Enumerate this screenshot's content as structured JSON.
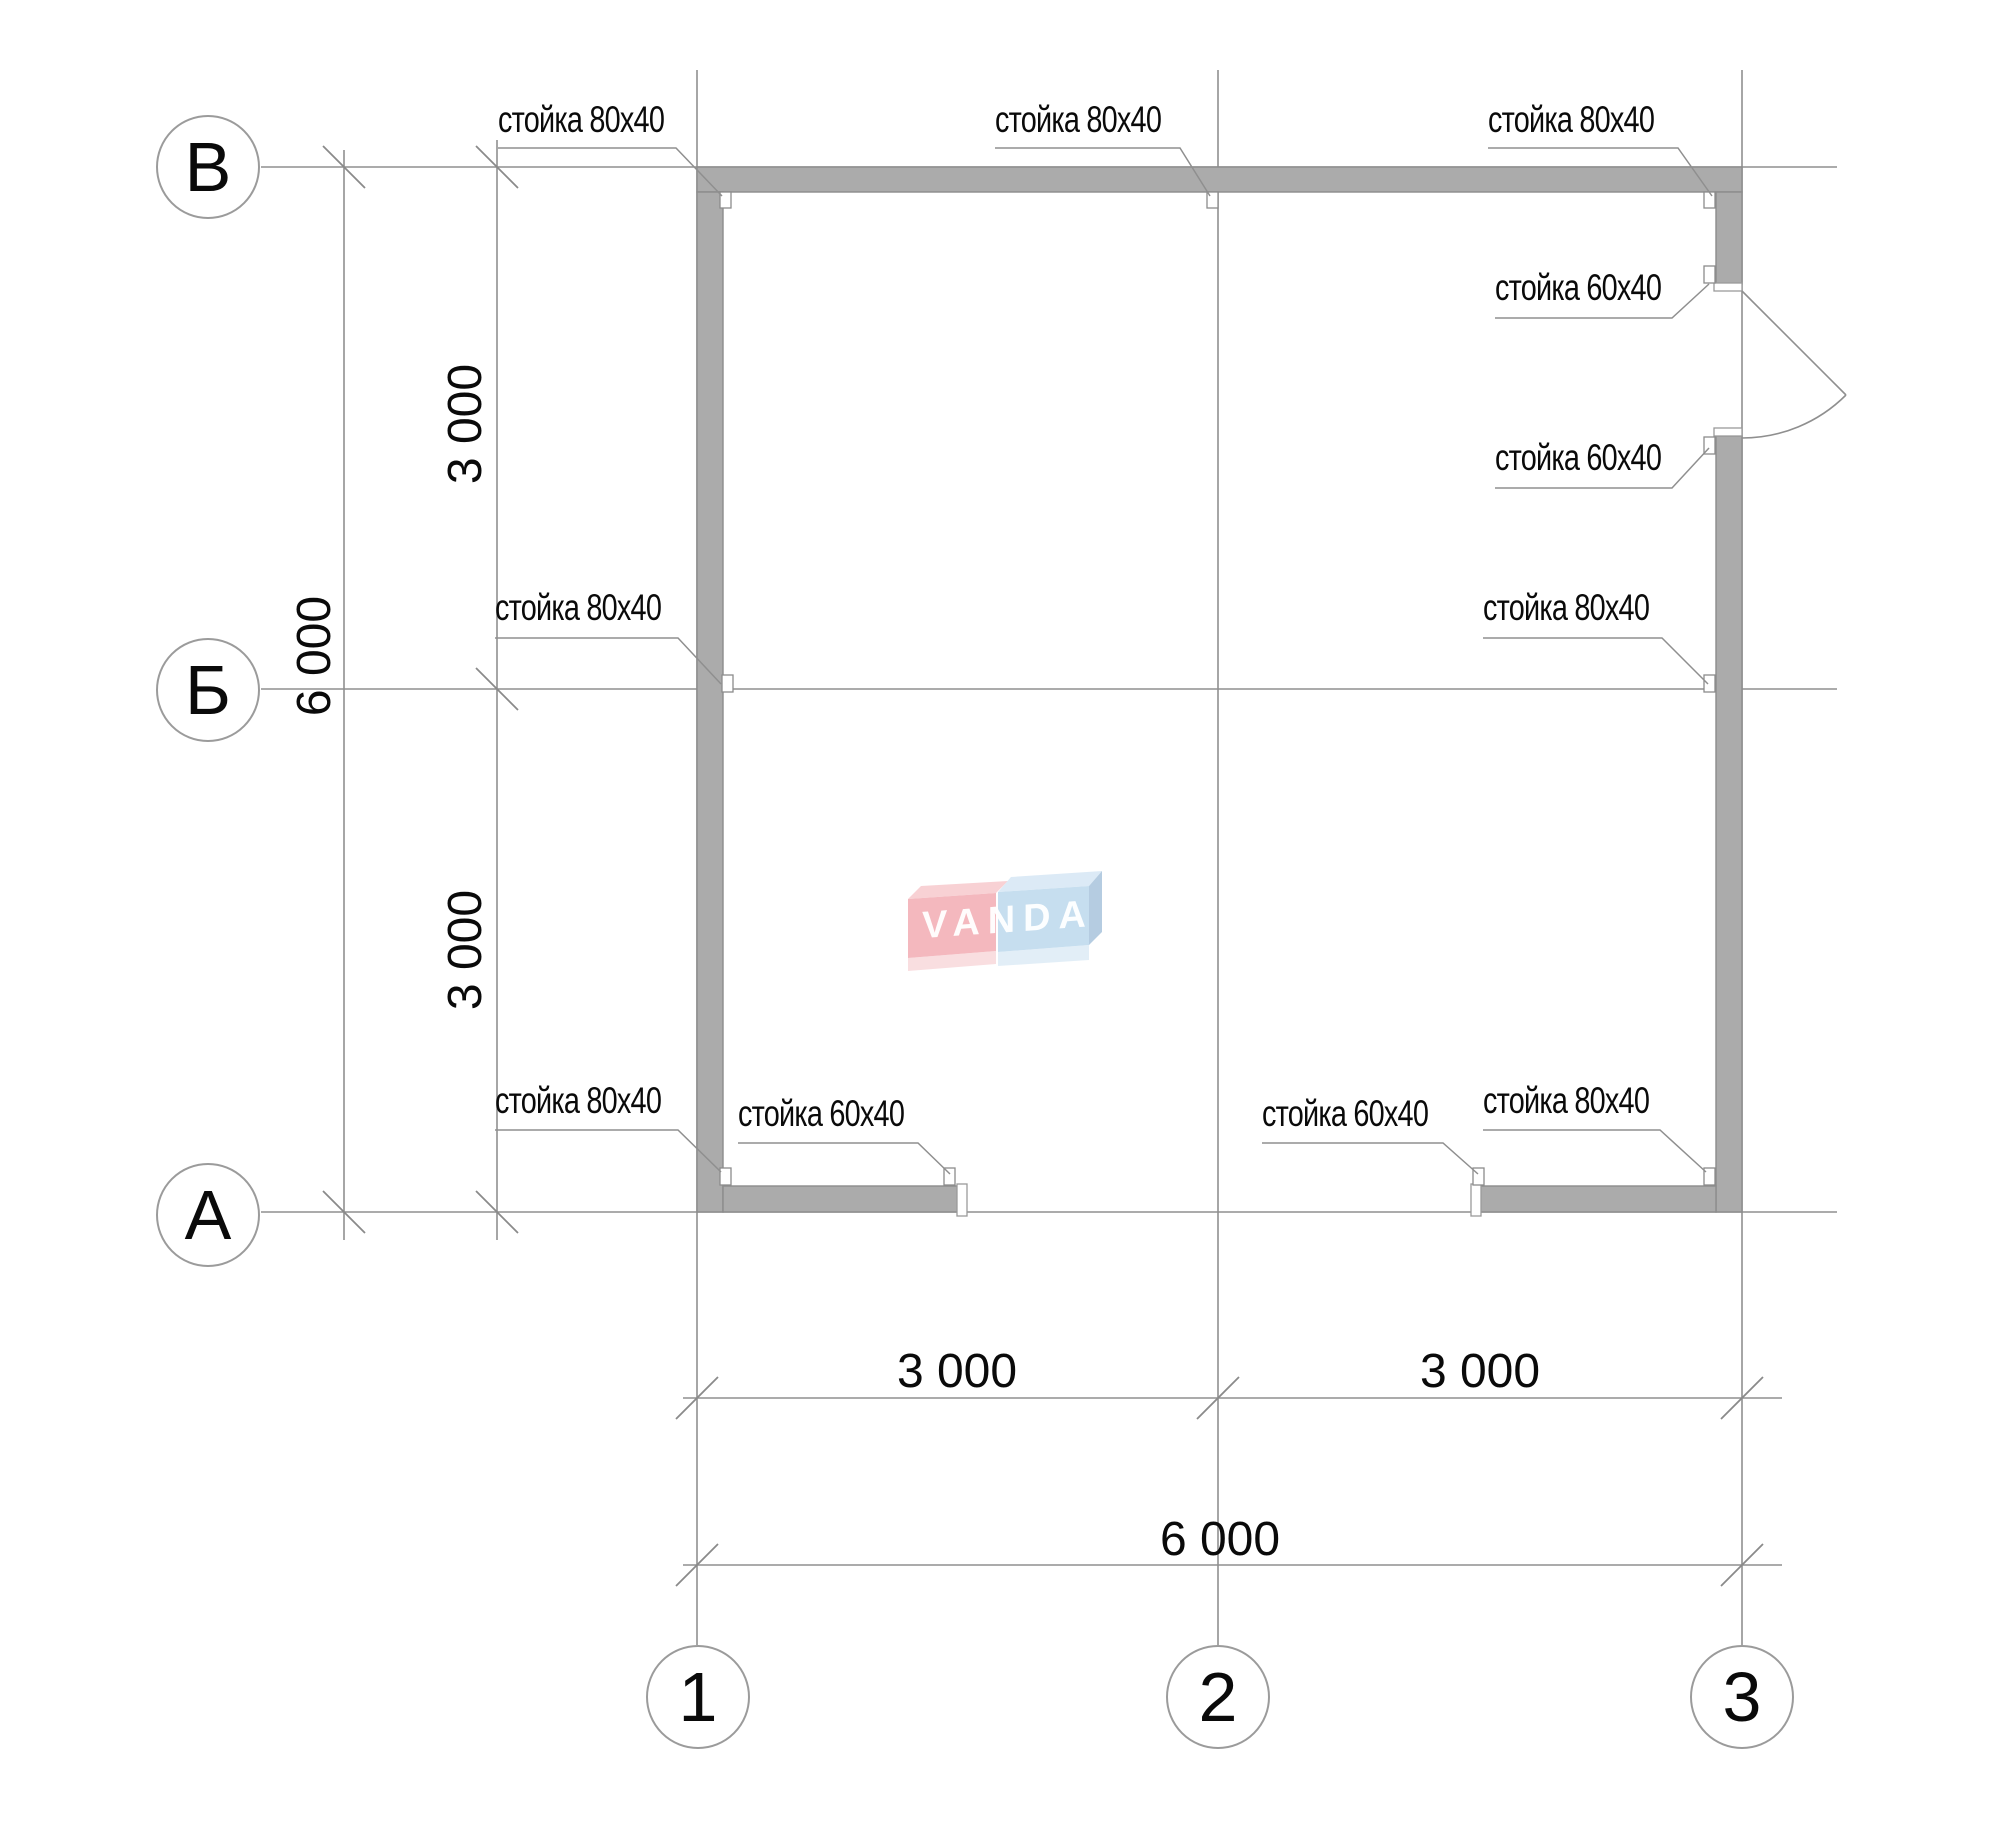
{
  "title": "frame-plan",
  "axes": {
    "rows": [
      {
        "label": "В"
      },
      {
        "label": "Б"
      },
      {
        "label": "А"
      }
    ],
    "cols": [
      {
        "label": "1"
      },
      {
        "label": "2"
      },
      {
        "label": "3"
      }
    ]
  },
  "dimensions": {
    "left_upper": "3 000",
    "left_lower": "3 000",
    "left_total": "6 000",
    "bottom_left": "3 000",
    "bottom_right": "3 000",
    "bottom_total": "6 000"
  },
  "callouts": [
    {
      "id": "top-left",
      "text": "стойка 80x40"
    },
    {
      "id": "top-middle",
      "text": "стойка 80x40"
    },
    {
      "id": "top-right",
      "text": "стойка 80x40"
    },
    {
      "id": "right-door-top",
      "text": "стойка 60x40"
    },
    {
      "id": "right-door-bottom",
      "text": "стойка 60x40"
    },
    {
      "id": "right-axis-b",
      "text": "стойка 80x40"
    },
    {
      "id": "left-axis-b",
      "text": "стойка 80x40"
    },
    {
      "id": "bottom-left-corner",
      "text": "стойка 80x40"
    },
    {
      "id": "bottom-left-60",
      "text": "стойка 60x40"
    },
    {
      "id": "bottom-right-60",
      "text": "стойка 60x40"
    },
    {
      "id": "bottom-right-corner",
      "text": "стойка 80x40"
    }
  ],
  "watermark": {
    "text": "VANDA"
  },
  "colors": {
    "wall_fill": "#ababab",
    "line": "#8a8a8a",
    "logo_red": "#f2a7ae",
    "logo_blue": "#b9d7ec"
  }
}
